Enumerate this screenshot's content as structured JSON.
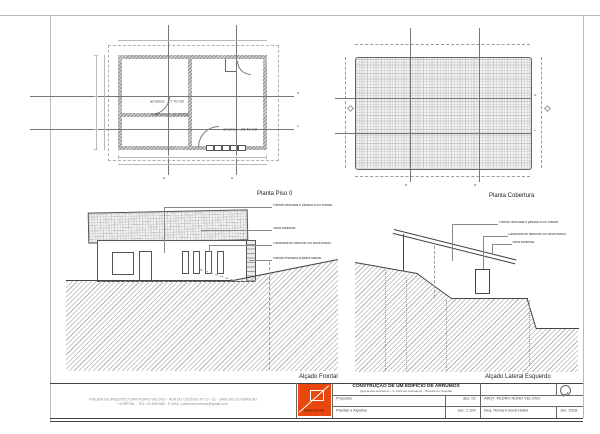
{
  "floor_plan": {
    "title": "Planta Piso 0",
    "room_labels": [
      "arrumos - 17.70 m2",
      "arrumos - 11.07 m2",
      "arrumos - 33.43 m2"
    ],
    "section_labels": {
      "a": "A'",
      "c": "C'",
      "b1": "B'",
      "b2": "B''"
    }
  },
  "roof_plan": {
    "title": "Planta Cobertura",
    "section_labels": {
      "a": "A'",
      "c": "C'",
      "b1": "B'",
      "b2": "B''"
    }
  },
  "front_elevation": {
    "title": "Alçado Frontal",
    "annotations": [
      "Parede rebocada e pintada à cor branca",
      "Telha cerâmica",
      "Caixilharia de alumínio cor cinza escuro",
      "Parede revestida a pedra natural"
    ]
  },
  "side_elevation": {
    "title": "Alçado Lateral Esquerdo",
    "annotations": [
      "Parede rebocada e pintada à cor branca",
      "Caixilharia de alumínio cor cinza escuro",
      "Telha cerâmica"
    ]
  },
  "title_block": {
    "firm_address_line1": "ATELIER DE ARQUITECTURA PEDRO VELOSO - RUA DO COLÉGIO Nº 10 - 1C - 3400-103 OLIVEIRA DO",
    "firm_address_line2": "HOSPITAL - TEL: 91 8467080 - E-MAIL: pedronunoveloso@gmail.com",
    "logo_text": "PEDRO VELOSO",
    "project_title": "CONSTRUÇÃO DE UM EDIFÍCIO DE ARRUMOS",
    "project_subtitle": "Quinta dos Azeiteiros - S. Paio de Gramaços - Oliveira do Hospital",
    "phase_label": "Proposta",
    "drawing_number": "des. 02",
    "sheet_contents": "Plantas e Alçados",
    "scale": "esc. 1:100",
    "architect": "ARQT. PEDRO NUNO VELOSO",
    "client": "Req. Richard Scott Hollar",
    "date": "Jun. 2018",
    "accent_color": "#e8480e"
  }
}
